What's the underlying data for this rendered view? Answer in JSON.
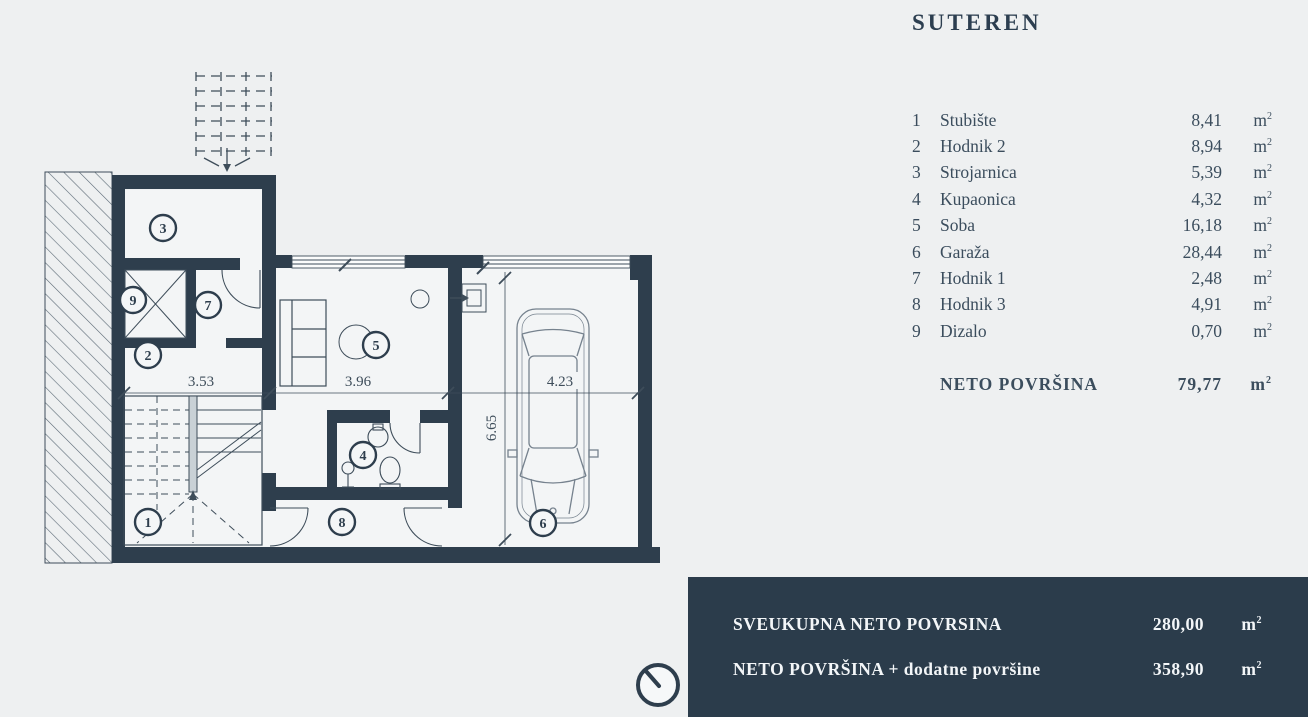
{
  "title": "SUTEREN",
  "units": {
    "base": "m",
    "exp": "2"
  },
  "legend": {
    "rows": [
      {
        "num": "1",
        "name": "Stubište",
        "value": "8,41"
      },
      {
        "num": "2",
        "name": "Hodnik 2",
        "value": "8,94"
      },
      {
        "num": "3",
        "name": "Strojarnica",
        "value": "5,39"
      },
      {
        "num": "4",
        "name": "Kupaonica",
        "value": "4,32"
      },
      {
        "num": "5",
        "name": "Soba",
        "value": "16,18"
      },
      {
        "num": "6",
        "name": "Garaža",
        "value": "28,44"
      },
      {
        "num": "7",
        "name": "Hodnik 1",
        "value": "2,48"
      },
      {
        "num": "8",
        "name": "Hodnik 3",
        "value": "4,91"
      },
      {
        "num": "9",
        "name": "Dizalo",
        "value": "0,70"
      }
    ],
    "total": {
      "label": "NETO POVRŠINA",
      "value": "79,77"
    }
  },
  "summary": {
    "rows": [
      {
        "label": "SVEUKUPNA NETO POVRSINA",
        "value": "280,00"
      },
      {
        "label": "NETO POVRŠINA + dodatne površine",
        "value": "358,90"
      }
    ]
  },
  "plan": {
    "rooms": [
      "1",
      "2",
      "3",
      "4",
      "5",
      "6",
      "7",
      "8",
      "9"
    ],
    "dims": {
      "room2_width": "3.53",
      "room5_width": "3.96",
      "garage_width": "4.23",
      "garage_depth": "6.65"
    }
  },
  "colors": {
    "background": "#eef0f1",
    "wall": "#2e3e4d",
    "line": "#3e4d5a",
    "panel": "#2b3c4b",
    "panel_text": "#f3f6f8",
    "text": "#3b4d5d"
  }
}
